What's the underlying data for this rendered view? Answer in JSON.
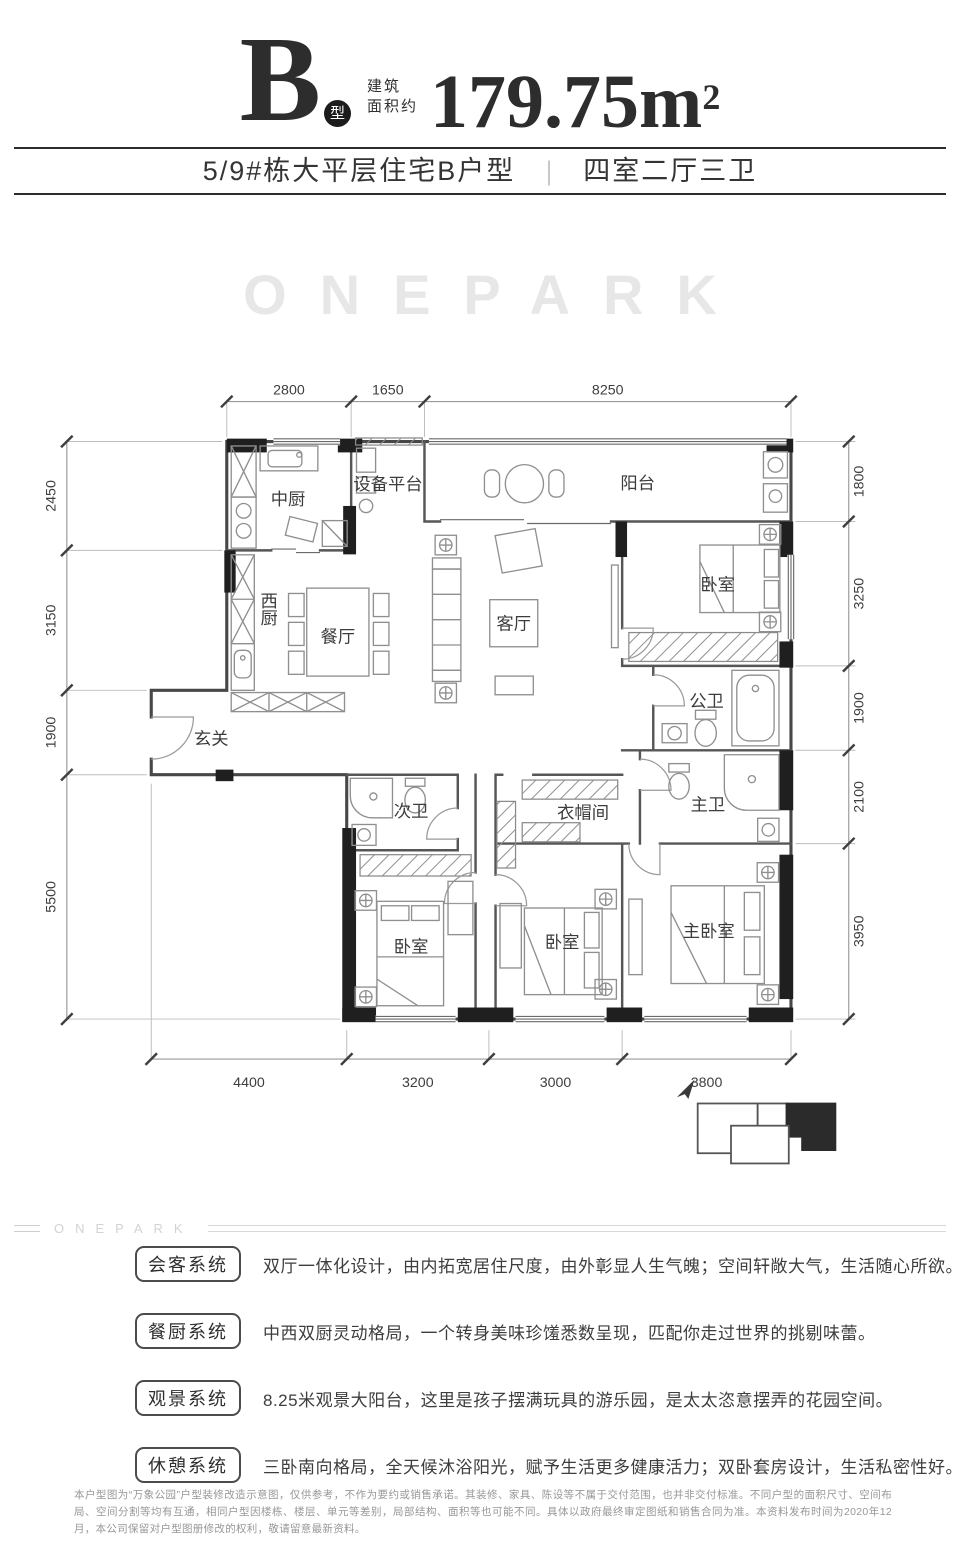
{
  "header": {
    "type_letter": "B",
    "type_badge": "型",
    "area_prefix_line1": "建筑",
    "area_prefix_line2": "面积约",
    "area_value": "179.75m",
    "area_sup": "2",
    "subtitle_left": "5/9#栋大平层住宅B户型",
    "subtitle_divider": "|",
    "subtitle_right": "四室二厅三卫"
  },
  "watermark": {
    "large": "ONEPARK",
    "small": "ONEPARK"
  },
  "plan": {
    "rooms": [
      {
        "label": "中厨"
      },
      {
        "label": "设备平台"
      },
      {
        "label": "阳台"
      },
      {
        "label": "西厨"
      },
      {
        "label": "餐厅"
      },
      {
        "label": "客厅"
      },
      {
        "label": "玄关"
      },
      {
        "label": "卧室"
      },
      {
        "label": "公卫"
      },
      {
        "label": "主卫"
      },
      {
        "label": "衣帽间"
      },
      {
        "label": "次卫"
      },
      {
        "label": "卧室"
      },
      {
        "label": "卧室"
      },
      {
        "label": "主卧室"
      }
    ],
    "dims_top": [
      "2800",
      "1650",
      "8250"
    ],
    "dims_bottom": [
      "4400",
      "3200",
      "3000",
      "3800"
    ],
    "dims_left": [
      "2450",
      "3150",
      "1900",
      "5500"
    ],
    "dims_right": [
      "1800",
      "3250",
      "1900",
      "2100",
      "3950"
    ]
  },
  "systems": [
    {
      "tag": "会客系统",
      "desc": "双厅一体化设计，由内拓宽居住尺度，由外彰显人生气魄；空间轩敞大气，生活随心所欲。"
    },
    {
      "tag": "餐厨系统",
      "desc": "中西双厨灵动格局，一个转身美味珍馐悉数呈现，匹配你走过世界的挑剔味蕾。"
    },
    {
      "tag": "观景系统",
      "desc": "8.25米观景大阳台，这里是孩子摆满玩具的游乐园，是太太恣意摆弄的花园空间。"
    },
    {
      "tag": "休憩系统",
      "desc": "三卧南向格局，全天候沐浴阳光，赋予生活更多健康活力；双卧套房设计，生活私密性好。"
    }
  ],
  "disclaimer": "本户型图为“万象公园”户型装修改造示意图，仅供参考，不作为要约或销售承诺。其装修、家具、陈设等不属于交付范围，也并非交付标准。不同户型的面积尺寸、空间布局、空间分割等均有互通，相同户型因楼栋、楼层、单元等差别，局部结构、面积等也可能不同。具体以政府最终审定图纸和销售合同为准。本资料发布时间为2020年12月，本公司保留对户型图册修改的权利，敬请留意最新资料。"
}
